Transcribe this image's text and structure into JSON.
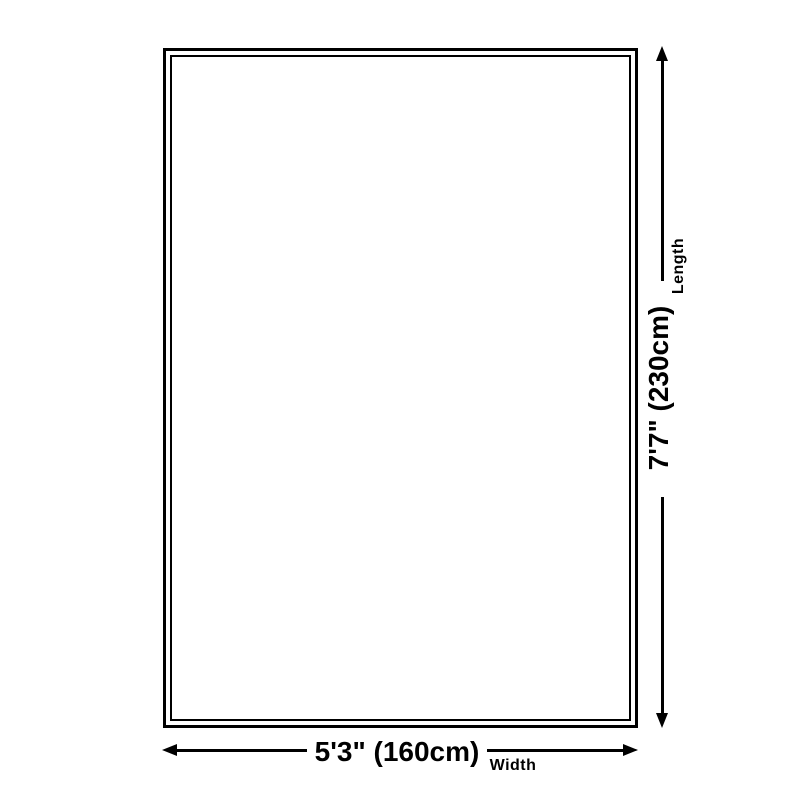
{
  "diagram": {
    "type": "product-dimension-diagram",
    "colors": {
      "line": "#000000",
      "background": "#ffffff"
    },
    "length": {
      "value_label": "7'7\" (230cm)",
      "axis_label": "Length"
    },
    "width": {
      "value_label": "5'3\" (160cm)",
      "axis_label": "Width"
    }
  }
}
